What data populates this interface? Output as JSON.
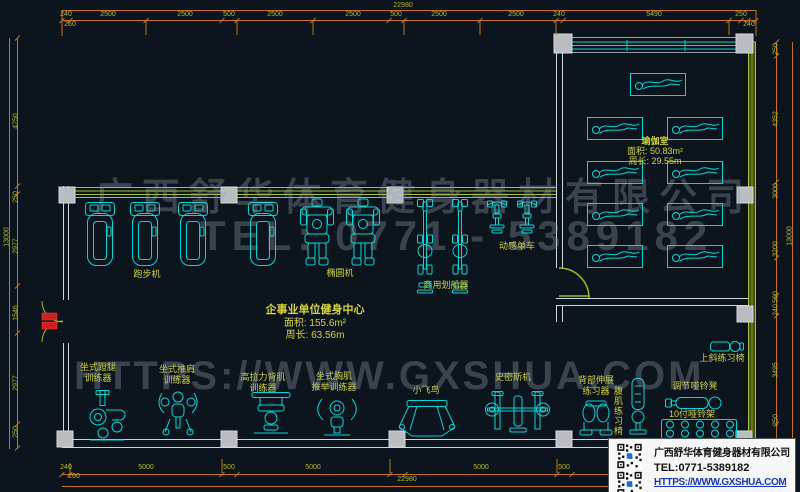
{
  "drawing": {
    "rooms": {
      "yoga": {
        "name": "瑜伽室",
        "area": "面积: 50.83m²",
        "perimeter": "周长: 29.55m"
      },
      "main": {
        "name": "企事业单位健身中心",
        "area": "面积: 155.6m²",
        "perimeter": "周长: 63.56m"
      }
    },
    "equipment": {
      "treadmill": "跑步机",
      "elliptical": "椭圆机",
      "rower": "商用划船器",
      "spin_bike": "动感单车",
      "leg_press_l1": "坐式蹬腿",
      "leg_press_l2": "训练器",
      "shoulder_press_l1": "坐式推肩",
      "shoulder_press_l2": "训练器",
      "lat_pull_l1": "高拉力背肌",
      "lat_pull_l2": "训练器",
      "chest_press_l1": "坐式胸肌",
      "chest_press_l2": "推举训练器",
      "cable_fly": "小飞鸟",
      "smith_machine": "史密斯机",
      "back_ext_l1": "背部伸展",
      "back_ext_l2": "练习器",
      "ab_chair": "腹肌练习椅",
      "adjust_bench": "调节哑铃凳",
      "dumbbell_rack": "10付哑铃架",
      "incline_bench": "上斜练习椅"
    },
    "dimensions": {
      "top_total": "22980",
      "top": [
        "240",
        "2500",
        "2500",
        "500",
        "2500",
        "2500",
        "500",
        "2500",
        "2500",
        "240",
        "5490",
        "250"
      ],
      "top_sub_left": "260",
      "top_sub_right": "240",
      "bottom": [
        "240",
        "5000",
        "500",
        "5000",
        "5000",
        "500"
      ],
      "bottom_sub_left": "260",
      "bottom_total": "22980",
      "left": [
        "4750",
        "250",
        "2977",
        "1546",
        "2977",
        "250"
      ],
      "left_total": "13000",
      "right": [
        "250",
        "4352",
        "3000",
        "3200",
        "500",
        "240",
        "3495",
        "250"
      ],
      "right_total": "13000"
    }
  },
  "watermark": {
    "line1": "广西舒华体育健身器材有限公司",
    "line2": "TEL: 0771 - 5389182",
    "line3": "HTTPS://WWW.GXSHUA.COM"
  },
  "info_box": {
    "company": "广西舒华体育健身器材有限公司",
    "tel": "TEL:0771-5389182",
    "url": "HTTPS://WWW.GXSHUA.COM"
  },
  "colors": {
    "background": "#0c141d",
    "cad_line": "#00d8d8",
    "label_yellow": "#d4d43a",
    "dimension_line": "#c2731c",
    "dimension_text": "#b9b92e",
    "wall_green": "#a8c41e",
    "wall_white": "#cfd4d8",
    "column_gray": "#b9bdc2",
    "door_red": "#cc2020",
    "link_blue": "#1536c8"
  }
}
